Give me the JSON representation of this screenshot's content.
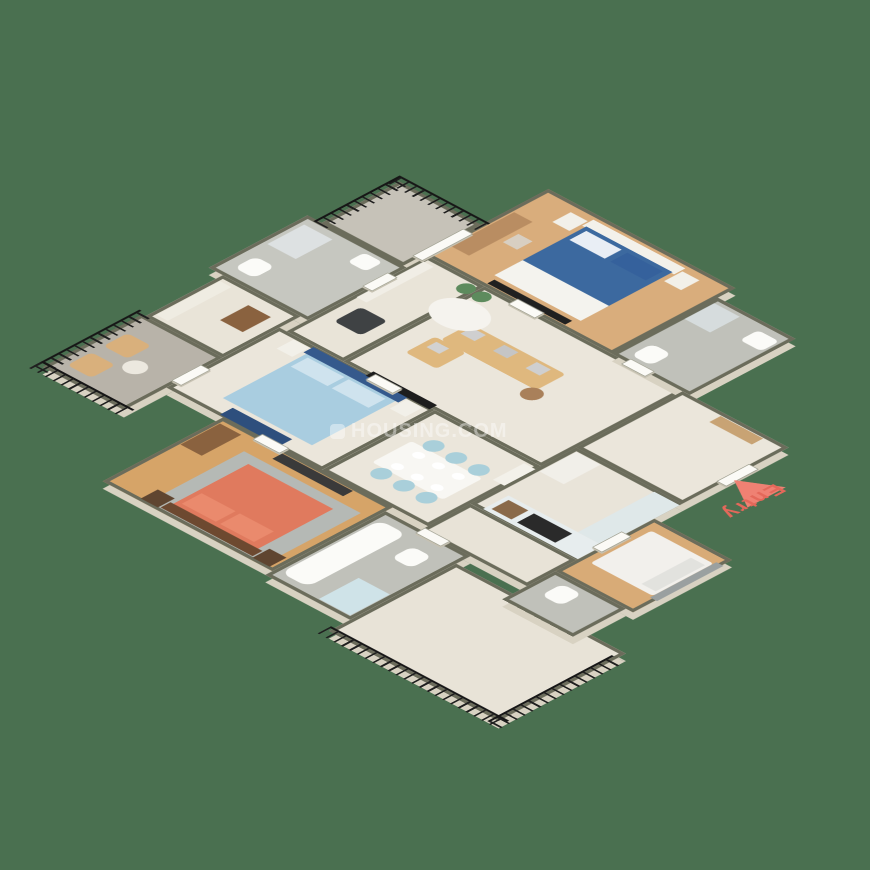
{
  "labels": {
    "entry": "Entry",
    "watermark": "HOUSING.COM"
  },
  "colors": {
    "background": "#4a7050",
    "wall_cap": "#6b6c5b",
    "wall_face": "#d8d2c2",
    "entry_accent": "#e4685a",
    "entry_triangle": "#ef8173",
    "watermark_text": "rgba(255,255,255,0.42)"
  },
  "plan": {
    "rooms": [
      {
        "id": "balcony-top",
        "x": 60,
        "y": 110,
        "w": 115,
        "h": 110,
        "floor": "#c6c2b8",
        "kind": "tile"
      },
      {
        "id": "bedroom-2",
        "x": 175,
        "y": 15,
        "w": 265,
        "h": 175,
        "floor": "#d9ad7c",
        "kind": "wood"
      },
      {
        "id": "bath-2",
        "x": 440,
        "y": 40,
        "w": 110,
        "h": 150,
        "floor": "#c0c1ba",
        "kind": "tile"
      },
      {
        "id": "common-bath",
        "x": 40,
        "y": 220,
        "w": 140,
        "h": 140,
        "floor": "#c6c7c0",
        "kind": "tile"
      },
      {
        "id": "wash-nook",
        "x": 180,
        "y": 190,
        "w": 80,
        "h": 200,
        "floor": "#e9e4d8",
        "kind": "tile"
      },
      {
        "id": "dressing",
        "x": 60,
        "y": 360,
        "w": 110,
        "h": 110,
        "floor": "#e9e4d8",
        "kind": "tile"
      },
      {
        "id": "living-room",
        "x": 260,
        "y": 190,
        "w": 280,
        "h": 200,
        "floor": "#ebe6db",
        "kind": "tile"
      },
      {
        "id": "foyer",
        "x": 540,
        "y": 190,
        "w": 150,
        "h": 150,
        "floor": "#ebe6db",
        "kind": "tile"
      },
      {
        "id": "kitchen",
        "x": 540,
        "y": 340,
        "w": 150,
        "h": 150,
        "floor": "#e9e4d9",
        "kind": "tile"
      },
      {
        "id": "dining",
        "x": 390,
        "y": 390,
        "w": 150,
        "h": 160,
        "floor": "#ebe6db",
        "kind": "tile"
      },
      {
        "id": "master-bedroom",
        "x": 170,
        "y": 390,
        "w": 220,
        "h": 160,
        "floor": "#ebe6db",
        "kind": "tile"
      },
      {
        "id": "balcony-left",
        "x": 55,
        "y": 470,
        "w": 115,
        "h": 140,
        "floor": "#b8b3a9",
        "kind": "tile"
      },
      {
        "id": "bedroom-3",
        "x": 250,
        "y": 550,
        "w": 240,
        "h": 170,
        "floor": "#d6a468",
        "kind": "wood"
      },
      {
        "id": "bath-3",
        "x": 490,
        "y": 560,
        "w": 120,
        "h": 170,
        "floor": "#c0c1ba",
        "kind": "tile"
      },
      {
        "id": "back-passage",
        "x": 540,
        "y": 490,
        "w": 150,
        "h": 70,
        "floor": "#e8e3d7",
        "kind": "tile"
      },
      {
        "id": "utility-room",
        "x": 690,
        "y": 380,
        "w": 110,
        "h": 140,
        "floor": "#d8ab77",
        "kind": "wood"
      },
      {
        "id": "utility-toilet",
        "x": 690,
        "y": 520,
        "w": 100,
        "h": 75,
        "floor": "#c0c1ba",
        "kind": "tile"
      },
      {
        "id": "balcony-bottom",
        "x": 610,
        "y": 580,
        "w": 240,
        "h": 180,
        "floor": "#e8e3d7",
        "kind": "tile"
      }
    ],
    "railings": [
      {
        "id": "balcony-top-rail",
        "o": "h",
        "x": 55,
        "y": 102,
        "w": 125,
        "h": 16
      },
      {
        "id": "balcony-top-rail-side",
        "o": "v",
        "x": 52,
        "y": 102,
        "w": 16,
        "h": 122
      },
      {
        "id": "balcony-left-rail",
        "o": "v",
        "x": 47,
        "y": 465,
        "w": 16,
        "h": 150
      },
      {
        "id": "balcony-left-rail-end",
        "o": "h",
        "x": 47,
        "y": 602,
        "w": 130,
        "h": 16
      },
      {
        "id": "balcony-bottom-rail",
        "o": "h",
        "x": 605,
        "y": 752,
        "w": 252,
        "h": 16
      },
      {
        "id": "balcony-bottom-rail-side",
        "o": "v",
        "x": 842,
        "y": 592,
        "w": 16,
        "h": 176
      }
    ],
    "doors": [
      {
        "id": "bedroom2-door",
        "x": 300,
        "y": 183,
        "w": 36,
        "h": 12
      },
      {
        "id": "bath2-door",
        "x": 460,
        "y": 183,
        "w": 32,
        "h": 12
      },
      {
        "id": "balcony-top-slider",
        "x": 168,
        "y": 128,
        "w": 12,
        "h": 70
      },
      {
        "id": "common-bath-door",
        "x": 173,
        "y": 240,
        "w": 12,
        "h": 34
      },
      {
        "id": "master-door",
        "x": 300,
        "y": 384,
        "w": 36,
        "h": 12
      },
      {
        "id": "balcony-left-door",
        "x": 164,
        "y": 495,
        "w": 12,
        "h": 40
      },
      {
        "id": "bedroom3-door",
        "x": 300,
        "y": 544,
        "w": 36,
        "h": 12
      },
      {
        "id": "bath3-door",
        "x": 540,
        "y": 554,
        "w": 34,
        "h": 12
      },
      {
        "id": "entry-door",
        "x": 684,
        "y": 240,
        "w": 12,
        "h": 44
      },
      {
        "id": "utility-door",
        "x": 684,
        "y": 420,
        "w": 12,
        "h": 40
      }
    ],
    "furniture": [
      {
        "id": "b2-headboard",
        "x": 248,
        "y": 24,
        "w": 130,
        "h": 16,
        "c": "#f3f1ea"
      },
      {
        "id": "b2-bed",
        "x": 252,
        "y": 38,
        "w": 122,
        "h": 96,
        "c": "#3c699f"
      },
      {
        "id": "b2-bed-foot-sheet",
        "x": 252,
        "y": 128,
        "w": 122,
        "h": 40,
        "c": "#f4f3ee"
      },
      {
        "id": "b2-pillow-left",
        "x": 258,
        "y": 44,
        "w": 50,
        "h": 24,
        "c": "#e9eef5"
      },
      {
        "id": "b2-pillow-right",
        "x": 316,
        "y": 44,
        "w": 50,
        "h": 24,
        "c": "#35619c"
      },
      {
        "id": "b2-nightstand-left",
        "x": 222,
        "y": 30,
        "w": 24,
        "h": 26,
        "c": "#f2f0e9"
      },
      {
        "id": "b2-nightstand-right",
        "x": 380,
        "y": 30,
        "w": 24,
        "h": 26,
        "c": "#f2f0e9"
      },
      {
        "id": "b2-tv",
        "x": 258,
        "y": 174,
        "w": 110,
        "h": 10,
        "c": "#202020"
      },
      {
        "id": "b2-desk",
        "x": 182,
        "y": 70,
        "w": 26,
        "h": 90,
        "c": "#b98d62"
      },
      {
        "id": "b2-stool",
        "x": 214,
        "y": 96,
        "w": 20,
        "h": 22,
        "c": "#d8cfc2"
      },
      {
        "id": "bt2-shower-tray",
        "x": 445,
        "y": 50,
        "w": 36,
        "h": 42,
        "c": "#d6dcdd"
      },
      {
        "id": "bt2-basin",
        "x": 512,
        "y": 55,
        "w": 30,
        "h": 26,
        "c": "#fbfbf8",
        "r": 6
      },
      {
        "id": "bt2-toilet",
        "x": 455,
        "y": 148,
        "w": 28,
        "h": 30,
        "c": "#fbfbf8",
        "r": 9
      },
      {
        "id": "cb-shower-tray",
        "x": 50,
        "y": 235,
        "w": 40,
        "h": 52,
        "c": "#dde1e2"
      },
      {
        "id": "cb-basin",
        "x": 130,
        "y": 230,
        "w": 26,
        "h": 24,
        "c": "#fbfbf8",
        "r": 6
      },
      {
        "id": "cb-toilet",
        "x": 58,
        "y": 312,
        "w": 28,
        "h": 30,
        "c": "#fbfbf8",
        "r": 9
      },
      {
        "id": "wn-wardrobe",
        "x": 184,
        "y": 200,
        "w": 14,
        "h": 95,
        "c": "#f1eee6"
      },
      {
        "id": "wn-washer",
        "x": 200,
        "y": 305,
        "w": 38,
        "h": 38,
        "c": "#3f4244",
        "r": 6
      },
      {
        "id": "wn-plant",
        "x": 240,
        "y": 196,
        "w": 20,
        "h": 20,
        "c": "#5d8b5d",
        "r": 99
      },
      {
        "id": "dr-wardrobe",
        "x": 66,
        "y": 370,
        "w": 16,
        "h": 90,
        "c": "#efece2"
      },
      {
        "id": "dr-chest",
        "x": 118,
        "y": 382,
        "w": 32,
        "h": 40,
        "c": "#8a623f"
      },
      {
        "id": "lv-sofa",
        "x": 300,
        "y": 250,
        "w": 135,
        "h": 42,
        "c": "#dfb87e",
        "r": 5
      },
      {
        "id": "lv-sofa-pillow-1",
        "x": 306,
        "y": 254,
        "w": 20,
        "h": 16,
        "c": "#cfcfcf"
      },
      {
        "id": "lv-sofa-pillow-2",
        "x": 352,
        "y": 254,
        "w": 20,
        "h": 16,
        "c": "#c5c5c5"
      },
      {
        "id": "lv-sofa-pillow-3",
        "x": 398,
        "y": 254,
        "w": 20,
        "h": 16,
        "c": "#cfcfcf"
      },
      {
        "id": "lv-armchair",
        "x": 292,
        "y": 292,
        "w": 44,
        "h": 42,
        "c": "#dfb87e",
        "r": 5
      },
      {
        "id": "lv-armchair-pillow",
        "x": 300,
        "y": 298,
        "w": 18,
        "h": 14,
        "c": "#d2d2d2"
      },
      {
        "id": "lv-coffee-table",
        "x": 245,
        "y": 218,
        "w": 70,
        "h": 54,
        "c": "#f5f3ee",
        "r": 99
      },
      {
        "id": "lv-side-table",
        "x": 425,
        "y": 288,
        "w": 24,
        "h": 24,
        "c": "#a9805a",
        "r": 99
      },
      {
        "id": "lv-plant",
        "x": 262,
        "y": 196,
        "w": 20,
        "h": 20,
        "c": "#5d8b5d",
        "r": 99
      },
      {
        "id": "fy-shoe-cabinet",
        "x": 600,
        "y": 196,
        "w": 60,
        "h": 16,
        "c": "#c8a374"
      },
      {
        "id": "kt-counter-bottom",
        "x": 556,
        "y": 452,
        "w": 134,
        "h": 36,
        "c": "#e7edee"
      },
      {
        "id": "kt-hob",
        "x": 598,
        "y": 458,
        "w": 54,
        "h": 24,
        "c": "#2a2a2a"
      },
      {
        "id": "kt-sink",
        "x": 562,
        "y": 458,
        "w": 28,
        "h": 24,
        "c": "#8a6a4a"
      },
      {
        "id": "kt-counter-right",
        "x": 654,
        "y": 344,
        "w": 36,
        "h": 108,
        "c": "#dfe8e9"
      },
      {
        "id": "kt-fridge",
        "x": 546,
        "y": 346,
        "w": 34,
        "h": 52,
        "c": "#f1efe9"
      },
      {
        "id": "dn-basin-cabinet",
        "x": 524,
        "y": 398,
        "w": 16,
        "h": 44,
        "c": "#f3f1ea"
      },
      {
        "id": "dn-table",
        "x": 415,
        "y": 448,
        "w": 100,
        "h": 56,
        "c": "#f8f7f3",
        "r": 4
      },
      {
        "id": "dn-chair-1",
        "x": 426,
        "y": 428,
        "w": 22,
        "h": 22,
        "c": "#a9cfda",
        "r": 99
      },
      {
        "id": "dn-chair-2",
        "x": 458,
        "y": 428,
        "w": 22,
        "h": 22,
        "c": "#a9cfda",
        "r": 99
      },
      {
        "id": "dn-chair-3",
        "x": 490,
        "y": 428,
        "w": 22,
        "h": 22,
        "c": "#a9cfda",
        "r": 99
      },
      {
        "id": "dn-chair-4",
        "x": 426,
        "y": 502,
        "w": 22,
        "h": 22,
        "c": "#a9cfda",
        "r": 99
      },
      {
        "id": "dn-chair-5",
        "x": 458,
        "y": 502,
        "w": 22,
        "h": 22,
        "c": "#a9cfda",
        "r": 99
      },
      {
        "id": "dn-chair-6",
        "x": 490,
        "y": 502,
        "w": 22,
        "h": 22,
        "c": "#a9cfda",
        "r": 99
      },
      {
        "id": "dn-plate-1",
        "x": 432,
        "y": 456,
        "w": 14,
        "h": 12,
        "c": "#ffffff",
        "r": 99
      },
      {
        "id": "dn-plate-2",
        "x": 460,
        "y": 456,
        "w": 14,
        "h": 12,
        "c": "#ffffff",
        "r": 99
      },
      {
        "id": "dn-plate-3",
        "x": 488,
        "y": 456,
        "w": 14,
        "h": 12,
        "c": "#ffffff",
        "r": 99
      },
      {
        "id": "dn-plate-4",
        "x": 432,
        "y": 486,
        "w": 14,
        "h": 12,
        "c": "#ffffff",
        "r": 99
      },
      {
        "id": "dn-plate-5",
        "x": 460,
        "y": 486,
        "w": 14,
        "h": 12,
        "c": "#ffffff",
        "r": 99
      },
      {
        "id": "dn-plate-6",
        "x": 488,
        "y": 486,
        "w": 14,
        "h": 12,
        "c": "#ffffff",
        "r": 99
      },
      {
        "id": "ms-headboard",
        "x": 220,
        "y": 392,
        "w": 134,
        "h": 14,
        "c": "#35598c"
      },
      {
        "id": "ms-bed",
        "x": 224,
        "y": 406,
        "w": 126,
        "h": 118,
        "c": "#a9cde0"
      },
      {
        "id": "ms-pillow-left",
        "x": 230,
        "y": 410,
        "w": 52,
        "h": 24,
        "c": "#cfe3ee"
      },
      {
        "id": "ms-pillow-right",
        "x": 288,
        "y": 410,
        "w": 52,
        "h": 24,
        "c": "#cfe3ee"
      },
      {
        "id": "ms-bench",
        "x": 244,
        "y": 530,
        "w": 84,
        "h": 18,
        "c": "#2e4f7d"
      },
      {
        "id": "ms-nightstand-left",
        "x": 196,
        "y": 396,
        "w": 22,
        "h": 24,
        "c": "#f2f0e9"
      },
      {
        "id": "ms-nightstand-right",
        "x": 356,
        "y": 396,
        "w": 22,
        "h": 24,
        "c": "#f2f0e9"
      },
      {
        "id": "ms-tv",
        "x": 295,
        "y": 382,
        "w": 90,
        "h": 11,
        "c": "#1d1d1d"
      },
      {
        "id": "bl-chair-1",
        "x": 70,
        "y": 505,
        "w": 34,
        "h": 34,
        "c": "#d9b07c",
        "r": 6
      },
      {
        "id": "bl-chair-2",
        "x": 70,
        "y": 556,
        "w": 34,
        "h": 34,
        "c": "#d9b07c",
        "r": 6
      },
      {
        "id": "bl-table",
        "x": 108,
        "y": 532,
        "w": 26,
        "h": 26,
        "c": "#ece8df",
        "r": 99
      },
      {
        "id": "b3-rug",
        "x": 310,
        "y": 580,
        "w": 165,
        "h": 135,
        "c": "#b5b9b5"
      },
      {
        "id": "b3-bed",
        "x": 330,
        "y": 594,
        "w": 120,
        "h": 108,
        "c": "#e07a5e"
      },
      {
        "id": "b3-pillow-left",
        "x": 336,
        "y": 666,
        "w": 48,
        "h": 28,
        "c": "#ea8a6d"
      },
      {
        "id": "b3-pillow-right",
        "x": 390,
        "y": 666,
        "w": 48,
        "h": 28,
        "c": "#ea8a6d"
      },
      {
        "id": "b3-headboard",
        "x": 326,
        "y": 700,
        "w": 130,
        "h": 14,
        "c": "#6d4930"
      },
      {
        "id": "b3-nightstand-left",
        "x": 300,
        "y": 692,
        "w": 24,
        "h": 24,
        "c": "#5f4530"
      },
      {
        "id": "b3-nightstand-right",
        "x": 458,
        "y": 692,
        "w": 24,
        "h": 24,
        "c": "#5f4530"
      },
      {
        "id": "b3-tv-unit",
        "x": 340,
        "y": 556,
        "w": 100,
        "h": 14,
        "c": "#3a3a3a"
      },
      {
        "id": "b3-dresser",
        "x": 256,
        "y": 560,
        "w": 30,
        "h": 56,
        "c": "#8a623f"
      },
      {
        "id": "b3b-tub",
        "x": 498,
        "y": 576,
        "w": 38,
        "h": 140,
        "c": "#fbfbf8",
        "r": 12
      },
      {
        "id": "b3b-toilet",
        "x": 556,
        "y": 588,
        "w": 28,
        "h": 30,
        "c": "#fbfbf8",
        "r": 9
      },
      {
        "id": "b3b-shower-glass",
        "x": 560,
        "y": 668,
        "w": 44,
        "h": 56,
        "c": "#cfe3e8"
      },
      {
        "id": "ut-bed",
        "x": 704,
        "y": 398,
        "w": 88,
        "h": 86,
        "c": "#f2f0ec",
        "r": 4
      },
      {
        "id": "ut-pillow",
        "x": 768,
        "y": 406,
        "w": 20,
        "h": 70,
        "c": "#e2e2de"
      },
      {
        "id": "ut-headboard",
        "x": 792,
        "y": 394,
        "w": 10,
        "h": 94,
        "c": "#9aa0a0"
      },
      {
        "id": "utt-toilet",
        "x": 712,
        "y": 532,
        "w": 28,
        "h": 30,
        "c": "#fbfbf8",
        "r": 9
      }
    ],
    "entry_marker": {
      "tri_x": 695,
      "tri_y": 245,
      "tri_size": 46,
      "label_x": 752,
      "label_y": 248
    }
  }
}
